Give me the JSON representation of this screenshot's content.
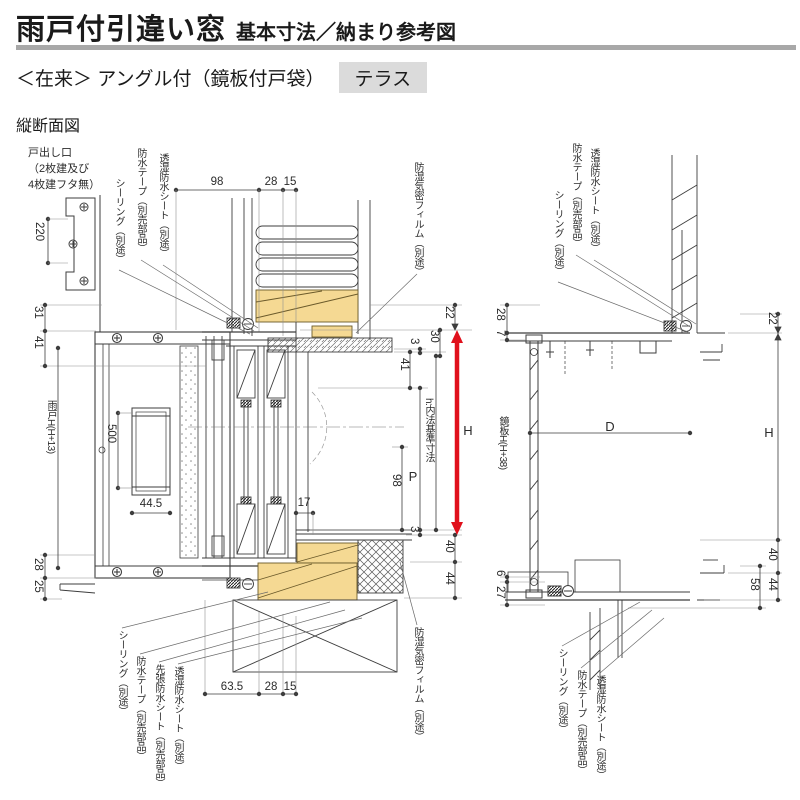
{
  "header": {
    "title": "雨戸付引違い窓",
    "subtitle": "基本寸法／納まり参考図",
    "variant": "＜在来＞ アングル付（鏡板付戸袋）",
    "badge": "テラス",
    "section_label": "縦断面図"
  },
  "colors": {
    "wood": "#f5d993",
    "accent": "#e0101c",
    "badge_bg": "#dbdbdb",
    "rule_gray": "#a8a8a8"
  },
  "left": {
    "note": [
      "戸出し口",
      "（2枚建及び",
      "4枚建フタ無）"
    ],
    "callouts_top": [
      "シーリング（別途）",
      "防水テープ（別売部品）",
      "透湿防水シート（別途）"
    ],
    "film_top": "防湿気密フィルム（別途）",
    "callouts_bottom": [
      "シーリング（別途）",
      "防水テープ（別売部品）",
      "先張防水シート（別売部品）",
      "透湿防水シート（別途）"
    ],
    "film_bottom": "防湿気密フィルム（別途）",
    "dims": {
      "bracket": "220",
      "top": [
        "98",
        "28",
        "15"
      ],
      "side_top": [
        "31",
        "41"
      ],
      "shutter_h": "雨戸H(H+13)",
      "side_bottom": [
        "28",
        "25"
      ],
      "handle_h": "500",
      "handle_w": "44.5",
      "r22": "22",
      "r30": "30",
      "r3a": "3",
      "r41": "41",
      "rH": "H",
      "rh": "h:内法基準寸法",
      "rP": "P",
      "r98": "98",
      "m17": "17",
      "r3b": "3",
      "r40": "40",
      "r44": "44",
      "bottom": [
        "63.5",
        "28",
        "15"
      ]
    }
  },
  "right": {
    "callouts_top": [
      "シーリング（別途）",
      "防水テープ（別売部品）",
      "透湿防水シート（別途）"
    ],
    "callouts_bottom": [
      "シーリング（別途）",
      "防水テープ（別売部品）",
      "透湿防水シート（別途）"
    ],
    "dims": {
      "l28": "28",
      "l7": "7",
      "panel_h": "鏡板H(H+38)",
      "l6": "6",
      "l27": "27",
      "D": "D",
      "r22": "22",
      "rH": "H",
      "r40": "40",
      "r58": "58",
      "r44": "44"
    }
  }
}
